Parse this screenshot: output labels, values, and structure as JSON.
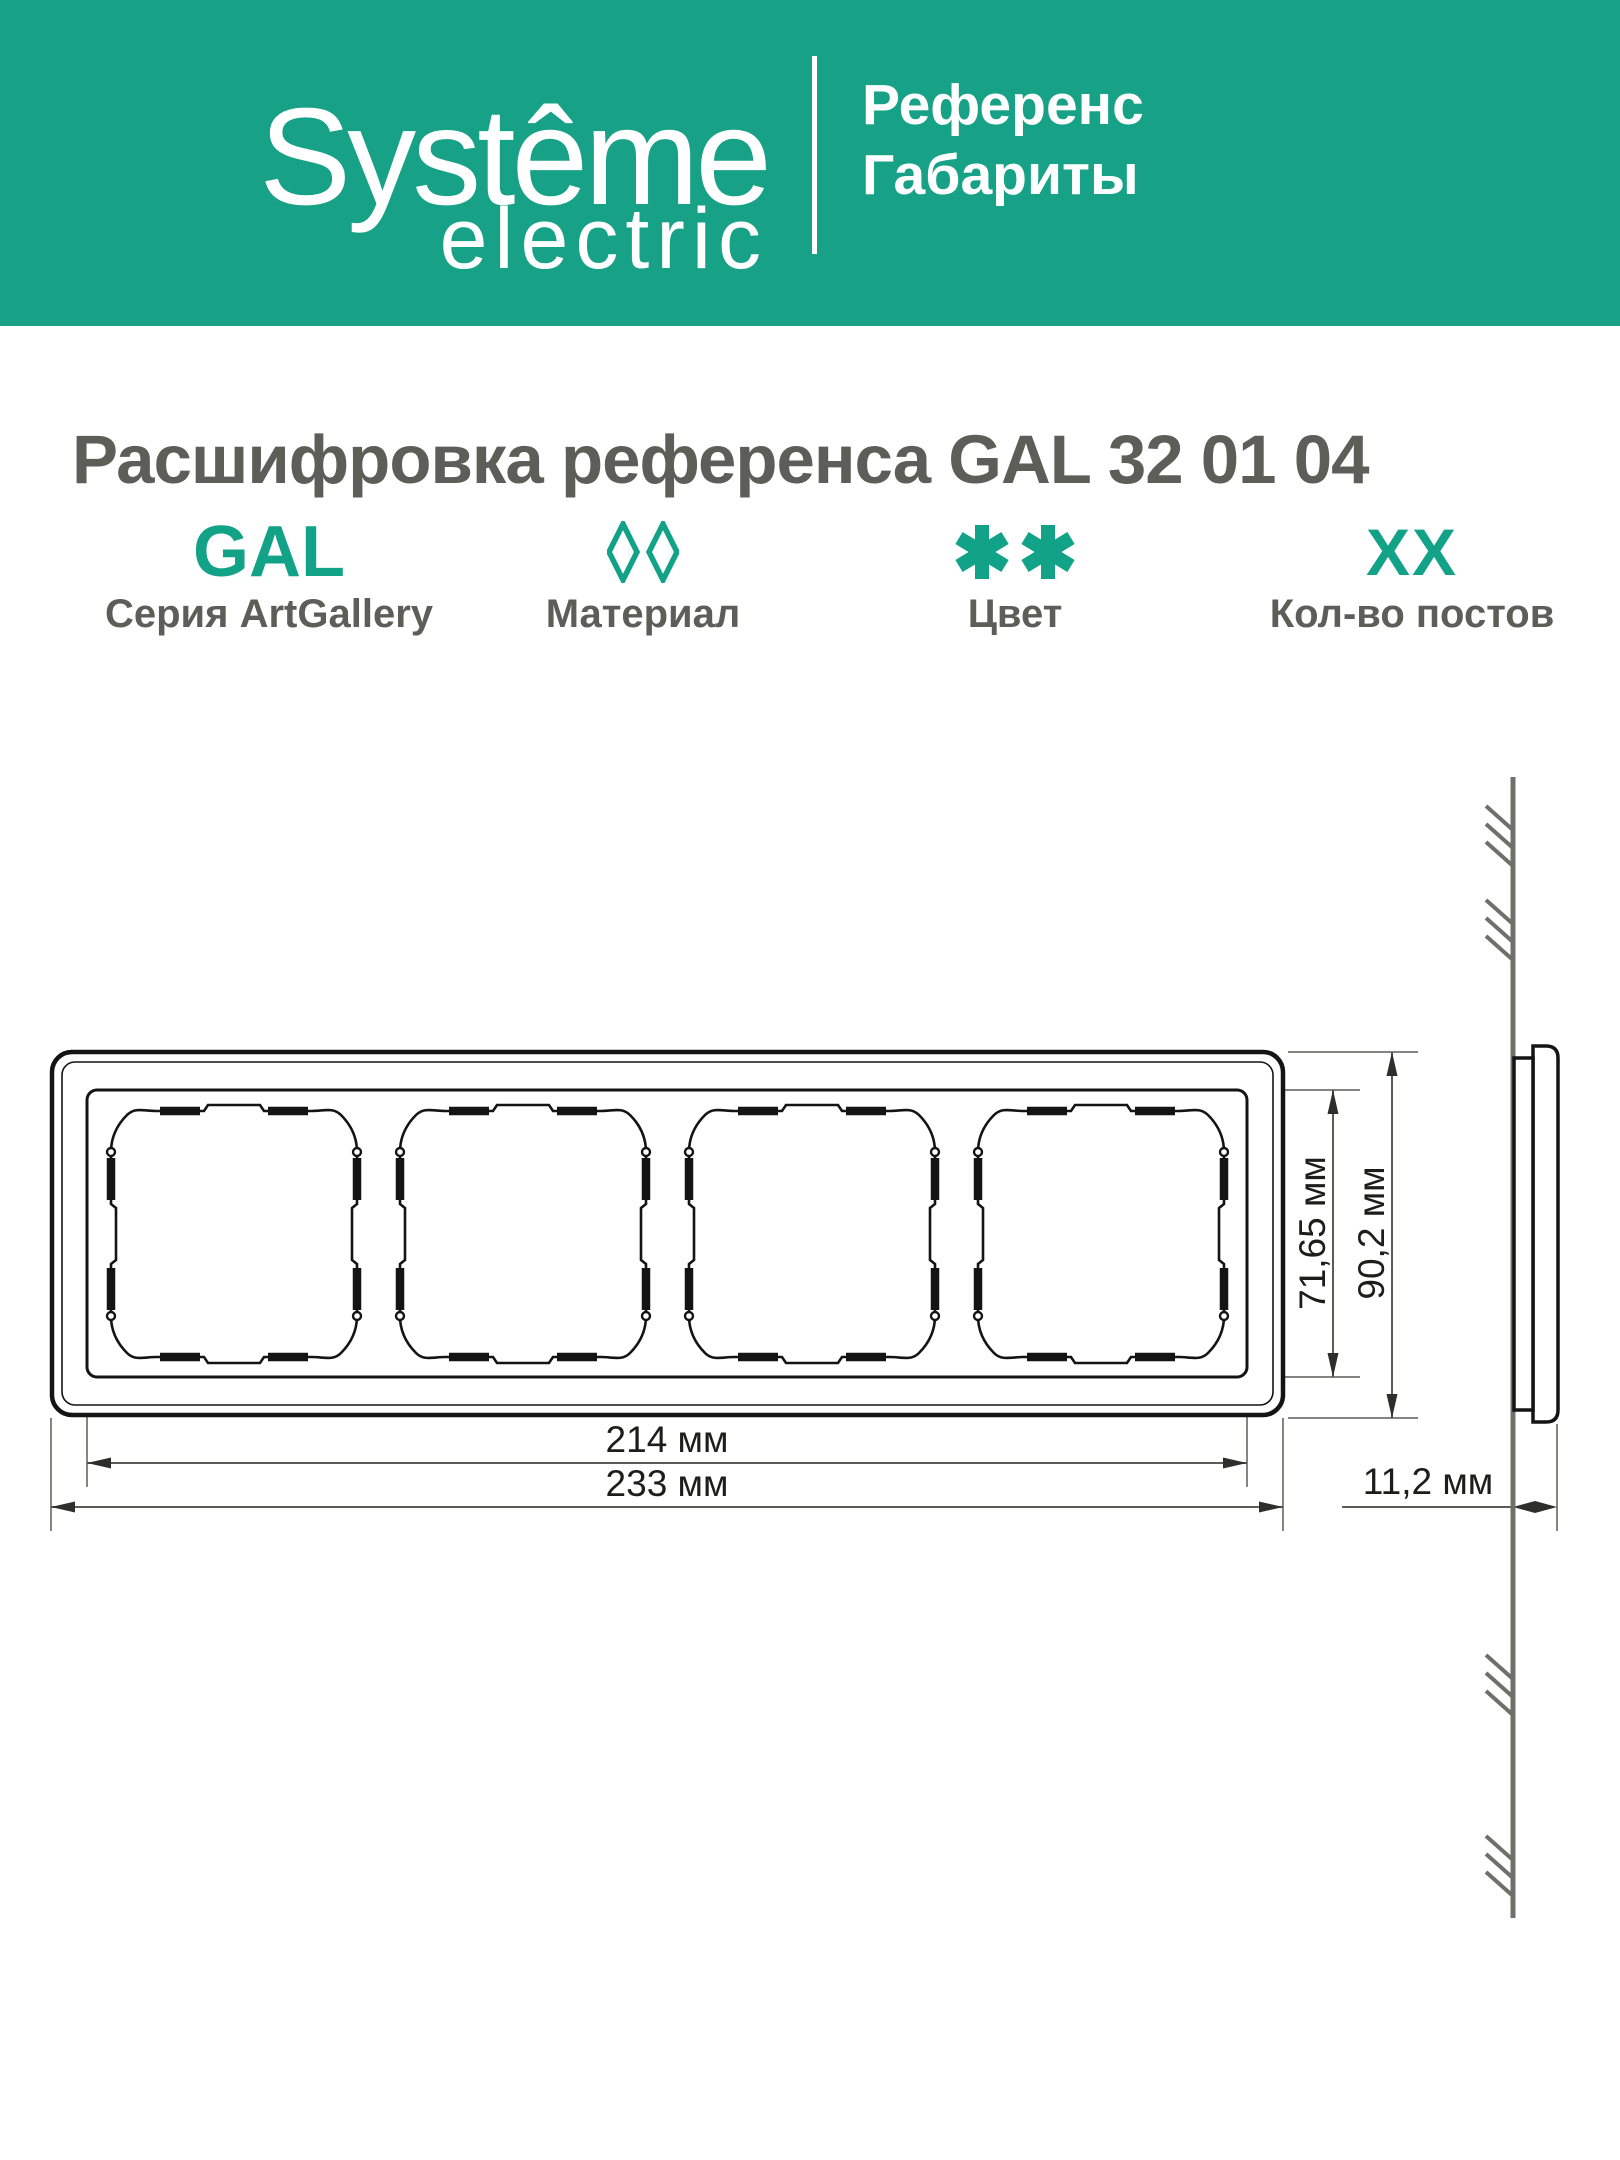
{
  "header": {
    "brand_line1": "Systême",
    "brand_line2": "electric",
    "doc_type": "Референс\nГабариты"
  },
  "title": "Расшифровка референса GAL 32 01 04",
  "legend": {
    "items": [
      {
        "code": "GAL",
        "label": "Серия ArtGallery",
        "icon": "gal-code-text"
      },
      {
        "code": "◊◊",
        "label": "Материал",
        "icon": "material-diamonds-icon"
      },
      {
        "code": "✱✱",
        "label": "Цвет",
        "icon": "color-asterisks-icon"
      },
      {
        "code": "XX",
        "label": "Кол-во постов",
        "icon": "posts-count-text"
      }
    ]
  },
  "drawing": {
    "views": [
      "front-view-4-post-frame",
      "side-profile-on-wall"
    ],
    "posts_count": 4,
    "dimensions": {
      "inner_height": "71,65 мм",
      "outer_height": "90,2 мм",
      "inner_width": "214 мм",
      "outer_width": "233 мм",
      "depth": "11,2 мм"
    }
  },
  "colors": {
    "brand_teal": "#17A287",
    "accent_teal": "#12A287",
    "text_gray": "#5E5E58",
    "line_dark": "#141414",
    "line_gray": "#85857F",
    "wall_gray": "#70706A"
  }
}
